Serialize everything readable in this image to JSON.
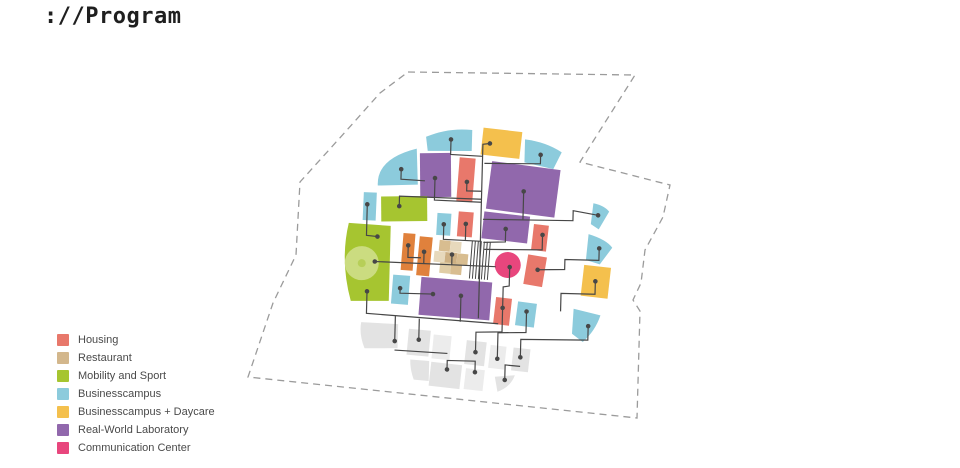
{
  "title": "://Program",
  "legend": {
    "items": [
      {
        "label": "Housing",
        "color": "#E8786B"
      },
      {
        "label": "Restaurant",
        "color": "#D3B78C"
      },
      {
        "label": "Mobility and Sport",
        "color": "#A6C530"
      },
      {
        "label": "Businesscampus",
        "color": "#8CCBDC"
      },
      {
        "label": "Businesscampus + Daycare",
        "color": "#F4C04D"
      },
      {
        "label": "Real-World Laboratory",
        "color": "#9168AC"
      },
      {
        "label": "Communication Center",
        "color": "#E8467D"
      }
    ]
  },
  "diagram": {
    "colors": {
      "housing": "#E8786B",
      "restaurant": "#D3B78C",
      "mobility": "#A6C530",
      "campus": "#8CCBDC",
      "daycare": "#F4C04D",
      "lab": "#9168AC",
      "comm": "#E8467D",
      "orange": "#E0813C",
      "ghost": "#E3E3E3",
      "ghost2": "#ECECEC",
      "tan1": "#D8BD90",
      "tan2": "#E7D9BC",
      "tan3": "#CDB083",
      "tan4": "#E0CDA6",
      "greenlight": "#CBDC80",
      "greendot": "#B7CF58",
      "connector": "#474747",
      "boundary": "#9B9B9B"
    },
    "boundary": {
      "points": [
        [
          408,
          72
        ],
        [
          635,
          75
        ],
        [
          580,
          162
        ],
        [
          670,
          185
        ],
        [
          663,
          217
        ],
        [
          645,
          250
        ],
        [
          641,
          283
        ],
        [
          633,
          300
        ],
        [
          640,
          311
        ],
        [
          637,
          418
        ],
        [
          248,
          377
        ],
        [
          273,
          303
        ],
        [
          296,
          255
        ],
        [
          300,
          182
        ],
        [
          347,
          130
        ],
        [
          380,
          93
        ]
      ],
      "dash": "7 5"
    },
    "ghost_blocks": [
      {
        "name": "ghost-wedge-left",
        "t": "path",
        "d": "M363,325 L400,326 L400,350 L367,351 Q361,337 363,325 Z",
        "f": "ghost"
      },
      {
        "name": "ghost-block",
        "t": "rect",
        "x": 410,
        "y": 331,
        "w": 22,
        "h": 26,
        "r": 4,
        "f": "ghost"
      },
      {
        "name": "ghost-block",
        "t": "rect",
        "x": 435,
        "y": 336,
        "w": 18,
        "h": 24,
        "r": 4,
        "f": "ghost2"
      },
      {
        "name": "ghost-block",
        "t": "rect",
        "x": 468,
        "y": 341,
        "w": 20,
        "h": 24,
        "r": 5,
        "f": "ghost"
      },
      {
        "name": "ghost-block",
        "t": "rect",
        "x": 492,
        "y": 345,
        "w": 16,
        "h": 23,
        "r": 5,
        "f": "ghost2"
      },
      {
        "name": "ghost-block",
        "t": "rect",
        "x": 515,
        "y": 347,
        "w": 17,
        "h": 23,
        "r": 5,
        "f": "ghost"
      },
      {
        "name": "ghost-wedge-low",
        "t": "path",
        "d": "M413,361 L432,362 L432,382 L417,381 Q413,371 413,361 Z",
        "f": "ghost"
      },
      {
        "name": "ghost-block",
        "t": "rect",
        "x": 433,
        "y": 364,
        "w": 31,
        "h": 24,
        "r": 5,
        "f": "ghost"
      },
      {
        "name": "ghost-block",
        "t": "rect",
        "x": 468,
        "y": 369,
        "w": 19,
        "h": 21,
        "r": 5,
        "f": "ghost2"
      },
      {
        "name": "ghost-wedge-right",
        "t": "path",
        "d": "M498,376 L518,374 Q514,386 501,391 Z",
        "f": "ghost"
      }
    ],
    "blocks": [
      {
        "name": "campus-arc-top-left",
        "t": "path",
        "d": "M425,152 L423,138 Q445,128 469,130 L469,151 Z",
        "f": "campus"
      },
      {
        "name": "daycare-top",
        "t": "rect",
        "x": 479,
        "y": 129,
        "w": 39,
        "h": 27,
        "r": 5,
        "f": "daycare"
      },
      {
        "name": "campus-arc-top-right",
        "t": "path",
        "d": "M522,138 Q543,140 559,150 L551,167 L522,161 Z",
        "f": "campus"
      },
      {
        "name": "campus-wedge-upper-left",
        "t": "path",
        "d": "M414,150 L416,186 L376,188 Q374,161 414,150 Z",
        "f": "campus"
      },
      {
        "name": "lab-upper",
        "t": "rect",
        "x": 418,
        "y": 154,
        "w": 31,
        "h": 44,
        "r": -2,
        "f": "lab"
      },
      {
        "name": "housing-upper",
        "t": "rect",
        "x": 456,
        "y": 158,
        "w": 16,
        "h": 44,
        "r": 3,
        "f": "housing"
      },
      {
        "name": "lab-large",
        "t": "rect",
        "x": 487,
        "y": 164,
        "w": 69,
        "h": 48,
        "r": 6,
        "f": "lab"
      },
      {
        "name": "mobility-upper",
        "t": "rect",
        "x": 380,
        "y": 198,
        "w": 46,
        "h": 25,
        "r": -2,
        "f": "mobility"
      },
      {
        "name": "campus-small-left",
        "t": "rect",
        "x": 362,
        "y": 195,
        "w": 13,
        "h": 28,
        "r": 1,
        "f": "campus"
      },
      {
        "name": "campus-small-mid",
        "t": "rect",
        "x": 436,
        "y": 214,
        "w": 14,
        "h": 22,
        "r": 2,
        "f": "campus"
      },
      {
        "name": "housing-mid",
        "t": "rect",
        "x": 457,
        "y": 212,
        "w": 15,
        "h": 25,
        "r": 3,
        "f": "housing"
      },
      {
        "name": "lab-mid",
        "t": "rect",
        "x": 482,
        "y": 213,
        "w": 46,
        "h": 27,
        "r": 5,
        "f": "lab"
      },
      {
        "name": "housing-right",
        "t": "rect",
        "x": 532,
        "y": 223,
        "w": 15,
        "h": 26,
        "r": 5,
        "f": "housing"
      },
      {
        "name": "campus-wedge-right-small",
        "t": "path",
        "d": "M592,200 Q603,202 608,208 L598,226 L590,221 Z",
        "f": "campus"
      },
      {
        "name": "campus-wedge-right",
        "t": "path",
        "d": "M588,231 Q606,236 612,244 L600,261 L586,257 Z",
        "f": "campus"
      },
      {
        "name": "mobility-large",
        "t": "path",
        "d": "M348,226 L390,228 L390,303 L352,304 Q340,264 348,226 Z",
        "f": "mobility"
      },
      {
        "name": "mobility-circle",
        "t": "circle",
        "cx": 362,
        "cy": 266,
        "rad": 17,
        "f": "greenlight"
      },
      {
        "name": "mobility-circle-dot",
        "t": "circle",
        "cx": 362,
        "cy": 266,
        "rad": 4,
        "f": "greendot"
      },
      {
        "name": "orange-block-a",
        "t": "rect",
        "x": 402,
        "y": 235,
        "w": 12,
        "h": 37,
        "r": 3,
        "f": "orange"
      },
      {
        "name": "orange-block-b",
        "t": "rect",
        "x": 418,
        "y": 238,
        "w": 13,
        "h": 39,
        "r": 4,
        "f": "orange"
      },
      {
        "name": "restaurant-cell",
        "t": "rect",
        "x": 439,
        "y": 241,
        "w": 11,
        "h": 11,
        "r": 4,
        "f": "tan1"
      },
      {
        "name": "restaurant-cell",
        "t": "rect",
        "x": 450,
        "y": 242,
        "w": 11,
        "h": 11,
        "r": 4,
        "f": "tan2"
      },
      {
        "name": "restaurant-cell",
        "t": "rect",
        "x": 434,
        "y": 252,
        "w": 11,
        "h": 11,
        "r": 4,
        "f": "tan2"
      },
      {
        "name": "restaurant-cell",
        "t": "rect",
        "x": 445,
        "y": 253,
        "w": 12,
        "h": 11,
        "r": 4,
        "f": "tan3"
      },
      {
        "name": "restaurant-cell",
        "t": "rect",
        "x": 457,
        "y": 254,
        "w": 11,
        "h": 11,
        "r": 4,
        "f": "tan1"
      },
      {
        "name": "restaurant-cell",
        "t": "rect",
        "x": 440,
        "y": 263,
        "w": 11,
        "h": 11,
        "r": 4,
        "f": "tan4"
      },
      {
        "name": "restaurant-cell",
        "t": "rect",
        "x": 451,
        "y": 264,
        "w": 11,
        "h": 11,
        "r": 4,
        "f": "tan1"
      },
      {
        "name": "housing-s4",
        "t": "rect",
        "x": 526,
        "y": 254,
        "w": 19,
        "h": 30,
        "r": 8,
        "f": "housing"
      },
      {
        "name": "comm-circle",
        "t": "circle",
        "cx": 508,
        "cy": 264,
        "rad": 13,
        "f": "comm"
      },
      {
        "name": "daycare-right",
        "t": "rect",
        "x": 583,
        "y": 263,
        "w": 27,
        "h": 31,
        "r": 5,
        "f": "daycare"
      },
      {
        "name": "campus-small-bottom-left",
        "t": "rect",
        "x": 393,
        "y": 277,
        "w": 17,
        "h": 29,
        "r": 3,
        "f": "campus"
      },
      {
        "name": "lab-bottom",
        "t": "rect",
        "x": 421,
        "y": 280,
        "w": 71,
        "h": 38,
        "r": 3,
        "f": "lab"
      },
      {
        "name": "housing-bottom",
        "t": "rect",
        "x": 496,
        "y": 297,
        "w": 16,
        "h": 27,
        "r": 5,
        "f": "housing"
      },
      {
        "name": "campus-small-bottom",
        "t": "rect",
        "x": 518,
        "y": 301,
        "w": 19,
        "h": 24,
        "r": 6,
        "f": "campus"
      },
      {
        "name": "campus-wedge-bottom-right",
        "t": "path",
        "d": "M575,306 L602,312 Q597,328 585,339 L574,331 Z",
        "f": "campus"
      }
    ],
    "hatch": {
      "x1": 471,
      "x2": 489,
      "step": 3,
      "y1": 241,
      "y2": 279,
      "rot": 3
    },
    "connectors": [
      {
        "pts": [
          [
            448,
            140
          ],
          [
            448,
            155
          ],
          [
            480,
            156
          ]
        ],
        "d1": true,
        "d2": false
      },
      {
        "pts": [
          [
            487,
            143
          ],
          [
            480,
            144
          ],
          [
            480,
            318
          ]
        ],
        "d1": true,
        "d2": false
      },
      {
        "pts": [
          [
            538,
            153
          ],
          [
            538,
            162
          ],
          [
            482,
            163
          ]
        ],
        "d1": true,
        "d2": false
      },
      {
        "pts": [
          [
            399,
            171
          ],
          [
            399,
            181
          ],
          [
            423,
            182
          ]
        ],
        "d1": true,
        "d2": false
      },
      {
        "pts": [
          [
            433,
            179
          ],
          [
            433,
            201
          ],
          [
            480,
            202
          ]
        ],
        "d1": true,
        "d2": false
      },
      {
        "pts": [
          [
            465,
            182
          ],
          [
            465,
            191
          ],
          [
            480,
            191
          ]
        ],
        "d1": true,
        "d2": false
      },
      {
        "pts": [
          [
            597,
            212
          ],
          [
            572,
            208
          ],
          [
            572,
            218
          ],
          [
            482,
            219
          ]
        ],
        "d1": true,
        "d2": false
      },
      {
        "pts": [
          [
            522,
            190
          ],
          [
            522,
            218
          ]
        ],
        "d1": true,
        "d2": false
      },
      {
        "pts": [
          [
            398,
            208
          ],
          [
            398,
            198
          ],
          [
            480,
            199
          ]
        ],
        "d1": true,
        "d2": false
      },
      {
        "pts": [
          [
            366,
            207
          ],
          [
            366,
            238
          ],
          [
            377,
            239
          ]
        ],
        "d1": true,
        "d2": true
      },
      {
        "pts": [
          [
            443,
            225
          ],
          [
            443,
            240
          ],
          [
            481,
            241
          ]
        ],
        "d1": true,
        "d2": false
      },
      {
        "pts": [
          [
            465,
            224
          ],
          [
            465,
            240
          ]
        ],
        "d1": true,
        "d2": false
      },
      {
        "pts": [
          [
            505,
            228
          ],
          [
            505,
            241
          ],
          [
            483,
            242
          ]
        ],
        "d1": true,
        "d2": false
      },
      {
        "pts": [
          [
            542,
            233
          ],
          [
            542,
            248
          ],
          [
            484,
            249
          ]
        ],
        "d1": true,
        "d2": false
      },
      {
        "pts": [
          [
            599,
            245
          ],
          [
            599,
            257
          ],
          [
            565,
            257
          ],
          [
            565,
            267
          ],
          [
            538,
            268
          ]
        ],
        "d1": true,
        "d2": true
      },
      {
        "pts": [
          [
            408,
            247
          ],
          [
            408,
            259
          ],
          [
            421,
            259
          ]
        ],
        "d1": true,
        "d2": false
      },
      {
        "pts": [
          [
            424,
            253
          ],
          [
            424,
            265
          ]
        ],
        "d1": true,
        "d2": false
      },
      {
        "pts": [
          [
            452,
            255
          ],
          [
            452,
            265
          ]
        ],
        "d1": true,
        "d2": false
      },
      {
        "pts": [
          [
            375,
            264
          ],
          [
            496,
            266
          ]
        ],
        "d1": true,
        "d2": false
      },
      {
        "pts": [
          [
            510,
            266
          ],
          [
            510,
            285
          ],
          [
            504,
            286
          ],
          [
            504,
            307
          ]
        ],
        "d1": true,
        "d2": true
      },
      {
        "pts": [
          [
            596,
            278
          ],
          [
            596,
            291
          ],
          [
            562,
            291
          ],
          [
            562,
            309
          ]
        ],
        "d1": true,
        "d2": false
      },
      {
        "pts": [
          [
            368,
            294
          ],
          [
            368,
            316
          ],
          [
            500,
            323
          ]
        ],
        "d1": true,
        "d2": false
      },
      {
        "pts": [
          [
            401,
            290
          ],
          [
            401,
            295
          ],
          [
            434,
            295
          ]
        ],
        "d1": true,
        "d2": true
      },
      {
        "pts": [
          [
            462,
            296
          ],
          [
            462,
            322
          ]
        ],
        "d1": true,
        "d2": false
      },
      {
        "pts": [
          [
            397,
            343
          ],
          [
            397,
            318
          ]
        ],
        "d1": true,
        "d2": false
      },
      {
        "pts": [
          [
            421,
            341
          ],
          [
            421,
            320
          ]
        ],
        "d1": true,
        "d2": false
      },
      {
        "pts": [
          [
            504,
            308
          ],
          [
            504,
            331
          ],
          [
            478,
            332
          ],
          [
            478,
            352
          ]
        ],
        "d1": false,
        "d2": true
      },
      {
        "pts": [
          [
            528,
            310
          ],
          [
            528,
            331
          ],
          [
            500,
            332
          ],
          [
            500,
            358
          ]
        ],
        "d1": true,
        "d2": true
      },
      {
        "pts": [
          [
            590,
            323
          ],
          [
            590,
            337
          ],
          [
            523,
            338
          ],
          [
            523,
            356
          ]
        ],
        "d1": true,
        "d2": true
      },
      {
        "pts": [
          [
            450,
            370
          ],
          [
            450,
            361
          ],
          [
            478,
            361
          ],
          [
            478,
            372
          ]
        ],
        "d1": true,
        "d2": true
      },
      {
        "pts": [
          [
            508,
            379
          ],
          [
            508,
            364
          ],
          [
            523,
            365
          ]
        ],
        "d1": true,
        "d2": false
      },
      {
        "pts": [
          [
            397,
            352
          ],
          [
            450,
            354
          ]
        ],
        "d1": false,
        "d2": false
      }
    ]
  }
}
